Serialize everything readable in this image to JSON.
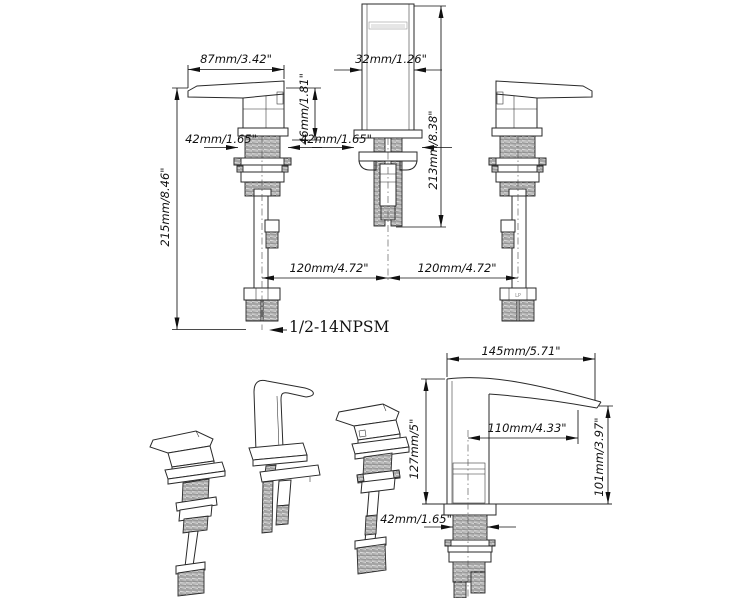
{
  "title": "Widespread basin faucet installation dimension drawing",
  "colors": {
    "line": "#2a2a2a",
    "dimension": "#111111",
    "background": "#ffffff"
  },
  "front_view": {
    "handle_width": "87mm/3.42\"",
    "spout_top_width": "32mm/1.26\"",
    "handle_height": "46mm/1.81\"",
    "handle_base_width": "42mm/1.65\"",
    "spout_base_width": "42mm/1.65\"",
    "spout_height": "213mm/8.38\"",
    "total_height": "215mm/8.46\"",
    "hole_spacing_left": "120mm/4.72\"",
    "hole_spacing_right": "120mm/4.72\"",
    "thread_spec": "1/2-14NPSM",
    "connector_mark": "LP"
  },
  "side_view": {
    "spout_length": "145mm/5.71\"",
    "spout_reach": "110mm/4.33\"",
    "deck_to_top_height": "127mm/5\"",
    "outlet_height": "101mm/3.97\"",
    "shank_width": "42mm/1.65\""
  }
}
